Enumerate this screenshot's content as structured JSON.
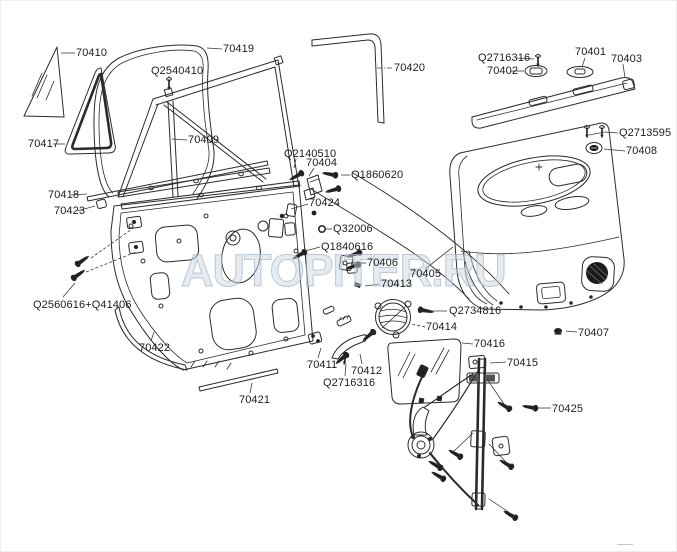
{
  "watermark": "AUTOPITER.RU",
  "diagram": {
    "line_color": "#2b2b2b",
    "background": "#ffffff",
    "watermark_color": "#cbd6e2"
  },
  "parts": [
    {
      "label": "70410",
      "x": 75,
      "y": 46
    },
    {
      "label": "70419",
      "x": 222,
      "y": 42
    },
    {
      "label": "Q2540410",
      "x": 150,
      "y": 64
    },
    {
      "label": "70420",
      "x": 393,
      "y": 61
    },
    {
      "label": "Q2716316",
      "x": 477,
      "y": 51
    },
    {
      "label": "70402",
      "x": 486,
      "y": 64
    },
    {
      "label": "70401",
      "x": 574,
      "y": 45
    },
    {
      "label": "70403",
      "x": 610,
      "y": 52
    },
    {
      "label": "70417",
      "x": 27,
      "y": 137
    },
    {
      "label": "70409",
      "x": 187,
      "y": 133
    },
    {
      "label": "Q2713595",
      "x": 618,
      "y": 126
    },
    {
      "label": "70408",
      "x": 625,
      "y": 144
    },
    {
      "label": "70418",
      "x": 47,
      "y": 188
    },
    {
      "label": "70423",
      "x": 53,
      "y": 204
    },
    {
      "label": "Q2140510",
      "x": 283,
      "y": 147
    },
    {
      "label": "70404",
      "x": 305,
      "y": 156
    },
    {
      "label": "Q1860620",
      "x": 350,
      "y": 168
    },
    {
      "label": "70424",
      "x": 308,
      "y": 196
    },
    {
      "label": "Q32006",
      "x": 332,
      "y": 222
    },
    {
      "label": "Q1840616",
      "x": 320,
      "y": 240
    },
    {
      "label": "70406",
      "x": 366,
      "y": 256
    },
    {
      "label": "70405",
      "x": 409,
      "y": 267
    },
    {
      "label": "70413",
      "x": 380,
      "y": 277
    },
    {
      "label": "Q2734816",
      "x": 448,
      "y": 304
    },
    {
      "label": "70414",
      "x": 425,
      "y": 320
    },
    {
      "label": "70416",
      "x": 473,
      "y": 337
    },
    {
      "label": "Q2560616+Q41406",
      "x": 32,
      "y": 298
    },
    {
      "label": "70422",
      "x": 138,
      "y": 341
    },
    {
      "label": "70411",
      "x": 306,
      "y": 358
    },
    {
      "label": "70412",
      "x": 350,
      "y": 364
    },
    {
      "label": "Q2716316",
      "x": 322,
      "y": 376
    },
    {
      "label": "70421",
      "x": 238,
      "y": 393
    },
    {
      "label": "70415",
      "x": 506,
      "y": 356
    },
    {
      "label": "70425",
      "x": 551,
      "y": 402
    },
    {
      "label": "70407",
      "x": 577,
      "y": 326
    }
  ]
}
